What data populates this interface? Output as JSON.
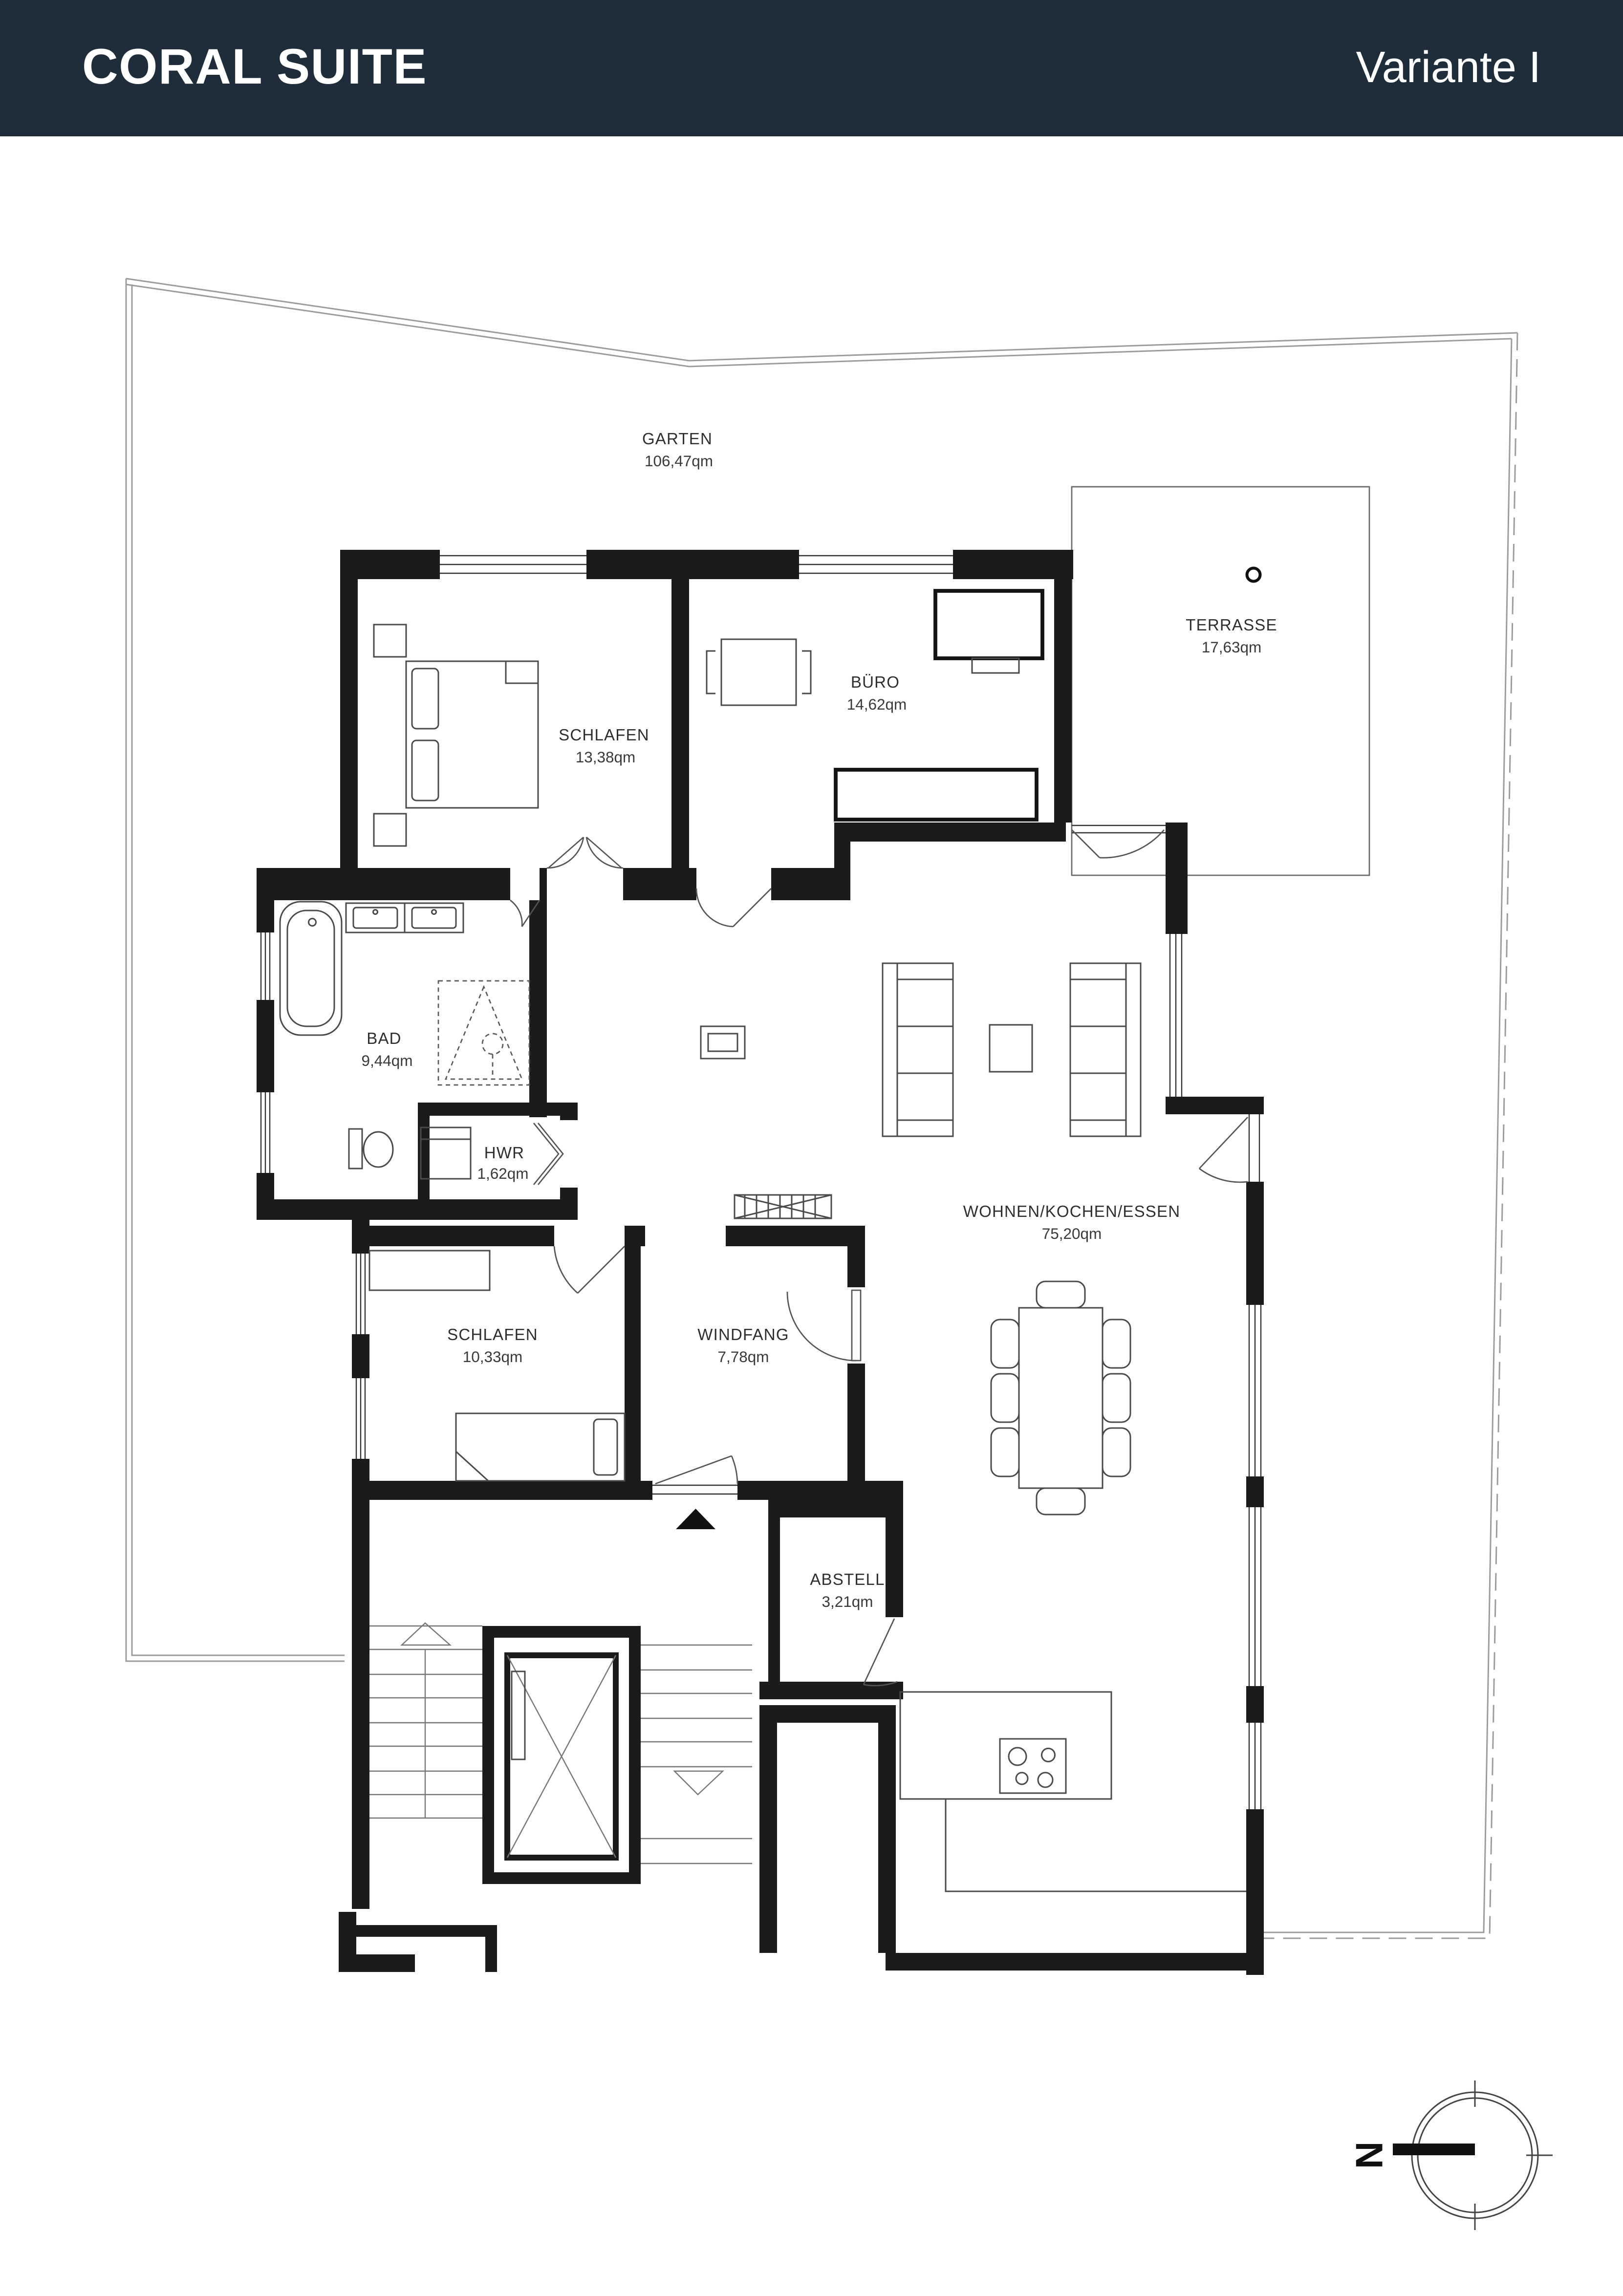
{
  "header": {
    "title": "CORAL SUITE",
    "variant": "Variante I",
    "bg_color": "#1f2d3b",
    "text_color": "#ffffff"
  },
  "rooms": {
    "garten": {
      "name": "GARTEN",
      "area": "106,47qm"
    },
    "terrasse": {
      "name": "TERRASSE",
      "area": "17,63qm"
    },
    "schlafen1": {
      "name": "SCHLAFEN",
      "area": "13,38qm"
    },
    "buero": {
      "name": "BÜRO",
      "area": "14,62qm"
    },
    "bad": {
      "name": "BAD",
      "area": "9,44qm"
    },
    "hwr": {
      "name": "HWR",
      "area": "1,62qm"
    },
    "wohnen": {
      "name": "WOHNEN/KOCHEN/ESSEN",
      "area": "75,20qm"
    },
    "schlafen2": {
      "name": "SCHLAFEN",
      "area": "10,33qm"
    },
    "windfang": {
      "name": "WINDFANG",
      "area": "7,78qm"
    },
    "abstell": {
      "name": "ABSTELL",
      "area": "3,21qm"
    }
  },
  "compass": {
    "label": "N"
  },
  "colors": {
    "walls": "#1b1b1b",
    "boundary": "#9c9c9c",
    "paper": "#ffffff"
  }
}
